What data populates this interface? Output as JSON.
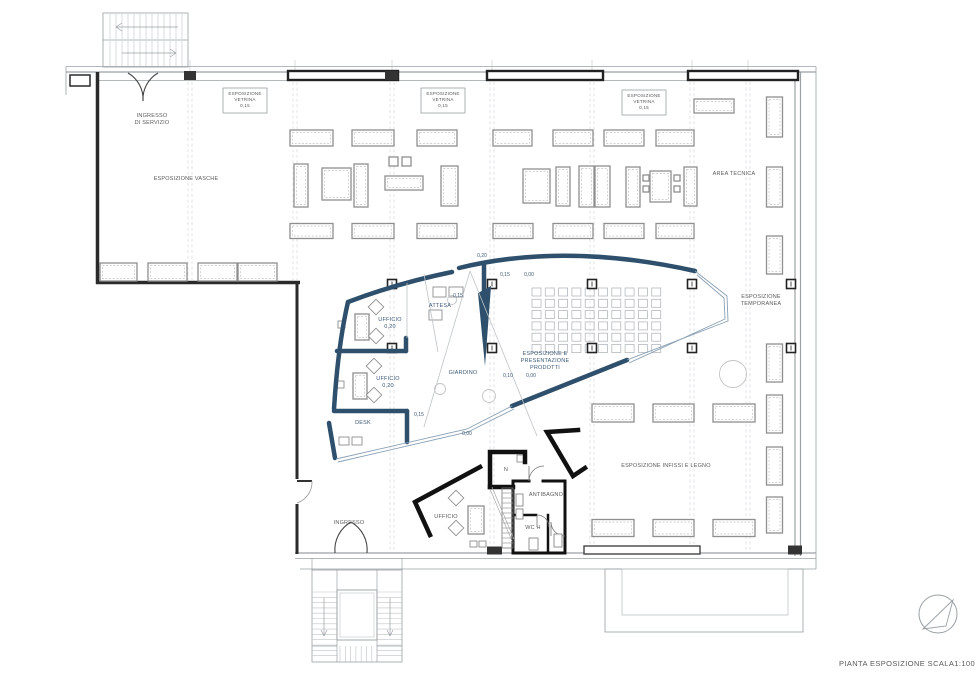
{
  "title": {
    "text": "PIANTA ESPOSIZIONE SCALA1:100",
    "x": 907,
    "y": 666
  },
  "colors": {
    "accent": "#2e506c",
    "accent_thin": "#8aa0b5",
    "wall_dark": "#2a2a2a",
    "room_black": "#111111",
    "furn": "#8f8f8f",
    "furn_inner": "#c4c4c4",
    "thin": "#9aa0a4",
    "lighter": "#bfc3c6",
    "grid": "#cdd1d4",
    "label_gray": "#5a5a5a",
    "label_blue": "#3c5a77"
  },
  "room_labels": [
    {
      "name": "ingresso-di-servizio",
      "lines": [
        "INGRESSO",
        "DI SERVIZIO"
      ],
      "x": 152,
      "y": 117,
      "c": "g"
    },
    {
      "name": "esposizione-vasche",
      "lines": [
        "ESPOSIZIONE VASCHE"
      ],
      "x": 186,
      "y": 180,
      "c": "g"
    },
    {
      "name": "area-tecnica",
      "lines": [
        "AREA TECNICA"
      ],
      "x": 734,
      "y": 175,
      "c": "g"
    },
    {
      "name": "esposizione-temporanea",
      "lines": [
        "ESPOSIZIONE",
        "TEMPORANEA"
      ],
      "x": 761,
      "y": 298,
      "c": "g"
    },
    {
      "name": "esposizione-presentazione-prodotti",
      "lines": [
        "ESPOSIZIONE E",
        "PRESENTAZIONE",
        "PRODOTTI"
      ],
      "x": 545,
      "y": 355,
      "c": "b"
    },
    {
      "name": "esposizione-infissi-legno",
      "lines": [
        "ESPOSIZIONE INFISSI E LEGNO"
      ],
      "x": 666,
      "y": 467,
      "c": "g"
    },
    {
      "name": "ufficio-1",
      "lines": [
        "UFFICIO",
        "0,20"
      ],
      "x": 390,
      "y": 321,
      "c": "b"
    },
    {
      "name": "ufficio-2",
      "lines": [
        "UFFICIO",
        "0,20"
      ],
      "x": 388,
      "y": 380,
      "c": "b"
    },
    {
      "name": "attesa",
      "lines": [
        "ATTESA"
      ],
      "x": 440,
      "y": 307,
      "c": "b"
    },
    {
      "name": "giardino",
      "lines": [
        "GIARDINO"
      ],
      "x": 463,
      "y": 374,
      "c": "b"
    },
    {
      "name": "desk",
      "lines": [
        "DESK"
      ],
      "x": 363,
      "y": 424,
      "c": "b"
    },
    {
      "name": "ingresso",
      "lines": [
        "INGRESSO"
      ],
      "x": 349,
      "y": 524,
      "c": "g"
    },
    {
      "name": "ufficio-basso",
      "lines": [
        "UFFICIO"
      ],
      "x": 446,
      "y": 518,
      "c": "g"
    },
    {
      "name": "n-room",
      "lines": [
        "N"
      ],
      "x": 506,
      "y": 471,
      "c": "g"
    },
    {
      "name": "antibagno",
      "lines": [
        "ANTIBAGNO"
      ],
      "x": 546,
      "y": 496,
      "c": "g"
    },
    {
      "name": "wc-h",
      "lines": [
        "WC H"
      ],
      "x": 533,
      "y": 529,
      "c": "g"
    }
  ],
  "vetrina_boxes": [
    {
      "lines": [
        "ESPOSIZIONE",
        "VETRINA",
        "0,15"
      ],
      "x": 223,
      "y": 88,
      "w": 44,
      "h": 25
    },
    {
      "lines": [
        "ESPOSIZIONE",
        "VETRINA",
        "0,15"
      ],
      "x": 421,
      "y": 88,
      "w": 44,
      "h": 25
    },
    {
      "lines": [
        "ESPOSIZIONE",
        "VETRINA",
        "0,15"
      ],
      "x": 622,
      "y": 90,
      "w": 44,
      "h": 25
    }
  ],
  "elevation_marks": [
    {
      "t": "0,20",
      "x": 482,
      "y": 257
    },
    {
      "t": "0,15",
      "x": 505,
      "y": 276
    },
    {
      "t": "0,00",
      "x": 529,
      "y": 276
    },
    {
      "t": "0,15",
      "x": 458,
      "y": 297
    },
    {
      "t": "0,10",
      "x": 508,
      "y": 377
    },
    {
      "t": "0,00",
      "x": 531,
      "y": 377
    },
    {
      "t": "0,15",
      "x": 419,
      "y": 416
    },
    {
      "t": "0,00",
      "x": 467,
      "y": 435
    }
  ],
  "frame": {
    "thin_lines": [
      [
        66,
        66.5,
        816,
        66.5
      ],
      [
        66,
        72,
        816,
        72
      ],
      [
        98,
        80.5,
        795,
        80.5
      ],
      [
        795,
        72,
        795,
        556
      ],
      [
        800.5,
        72,
        800.5,
        556
      ],
      [
        816,
        66.5,
        816,
        569
      ],
      [
        295,
        553,
        816,
        553
      ],
      [
        295,
        558.5,
        816,
        558.5
      ],
      [
        300,
        569,
        816,
        569
      ],
      [
        66,
        66.5,
        66,
        95
      ]
    ],
    "dark_walls": [
      {
        "x1": 97.5,
        "y1": 72,
        "x2": 97.5,
        "y2": 284,
        "w": 3.5
      },
      {
        "x1": 96,
        "y1": 282.5,
        "x2": 300,
        "y2": 282.5,
        "w": 3.5
      },
      {
        "x1": 297,
        "y1": 284,
        "x2": 297,
        "y2": 479,
        "w": 3
      },
      {
        "x1": 297,
        "y1": 504,
        "x2": 297,
        "y2": 554,
        "w": 3
      }
    ],
    "pier_outline": [
      70,
      75,
      20,
      11
    ],
    "vetrina_bars": [
      [
        288,
        71,
        110,
        9
      ],
      [
        487,
        71,
        116,
        9
      ],
      [
        688,
        71,
        110,
        9
      ]
    ],
    "top_piers": [
      [
        184,
        71,
        12,
        9
      ],
      [
        385,
        71,
        13,
        9
      ]
    ],
    "bottom_piers": [
      [
        487,
        546.5,
        15,
        8
      ],
      [
        587,
        546.5,
        15,
        8
      ],
      [
        788,
        545.5,
        14,
        9
      ]
    ],
    "bottom_window": [
      584,
      546,
      116,
      8
    ],
    "wing_rects": [
      [
        605,
        569,
        198,
        63
      ],
      [
        622,
        569,
        166,
        46
      ]
    ]
  },
  "gridlines": [
    {
      "x": 190,
      "y1": 82,
      "y2": 280
    },
    {
      "x": 295,
      "y1": 82,
      "y2": 280
    },
    {
      "x": 392,
      "y1": 82,
      "y2": 551
    },
    {
      "x": 492,
      "y1": 82,
      "y2": 551
    },
    {
      "x": 592,
      "y1": 82,
      "y2": 551
    },
    {
      "x": 692,
      "y1": 82,
      "y2": 551
    },
    {
      "x": 748,
      "y1": 82,
      "y2": 551
    }
  ],
  "columns": [
    [
      392,
      284
    ],
    [
      492,
      284
    ],
    [
      592,
      284
    ],
    [
      692,
      284
    ],
    [
      392,
      348
    ],
    [
      492,
      348
    ],
    [
      592,
      348
    ],
    [
      692,
      348
    ],
    [
      791,
      284
    ],
    [
      791,
      348
    ]
  ],
  "furniture": {
    "h_rects": [
      [
        290,
        130,
        43,
        16
      ],
      [
        352,
        130,
        42,
        16
      ],
      [
        417,
        130,
        40,
        16
      ],
      [
        493,
        130,
        39,
        16
      ],
      [
        553,
        130,
        40,
        16
      ],
      [
        604,
        130,
        40,
        16
      ],
      [
        656,
        130,
        38,
        16
      ],
      [
        290,
        223.5,
        43,
        15
      ],
      [
        352,
        223.5,
        42,
        15
      ],
      [
        417,
        223.5,
        40,
        15
      ],
      [
        493,
        223.5,
        40,
        15
      ],
      [
        553,
        223.5,
        40,
        15
      ],
      [
        604,
        223.5,
        40,
        15
      ],
      [
        656,
        223.5,
        38,
        15
      ],
      [
        694,
        99,
        40,
        14
      ],
      [
        592,
        404,
        42,
        18
      ],
      [
        653,
        404,
        41,
        18
      ],
      [
        713,
        404,
        42,
        18
      ],
      [
        592,
        519.5,
        42,
        17
      ],
      [
        653,
        519.5,
        41,
        17
      ],
      [
        713,
        519.5,
        42,
        17
      ],
      [
        100,
        263,
        37,
        18
      ],
      [
        148,
        263,
        39,
        18
      ],
      [
        198,
        263,
        39,
        18
      ],
      [
        238,
        263,
        39,
        18
      ]
    ],
    "v_rects": [
      [
        766.5,
        97,
        16,
        40
      ],
      [
        766.5,
        167,
        16,
        40
      ],
      [
        766.5,
        236,
        16,
        38
      ],
      [
        766.5,
        344,
        16,
        38
      ],
      [
        766.5,
        395,
        16,
        38
      ],
      [
        766.5,
        447,
        16,
        38
      ],
      [
        766.5,
        497,
        16,
        36
      ]
    ],
    "mid_items": [
      [
        294,
        164,
        14,
        43
      ],
      [
        322,
        168,
        29,
        32
      ],
      [
        354,
        164,
        14,
        43
      ],
      [
        385,
        176,
        38,
        14
      ],
      [
        389,
        157,
        9,
        9
      ],
      [
        402,
        157,
        9,
        9
      ],
      [
        441,
        166,
        17,
        40
      ],
      [
        523,
        169,
        27,
        34
      ],
      [
        556,
        167,
        14,
        39
      ],
      [
        579,
        166,
        15,
        41
      ],
      [
        595,
        166,
        15,
        41
      ],
      [
        626,
        167,
        14,
        40
      ],
      [
        650,
        171,
        21,
        31
      ],
      [
        643,
        175,
        6,
        6
      ],
      [
        643,
        186,
        6,
        6
      ],
      [
        674,
        175,
        6,
        6
      ],
      [
        674,
        186,
        6,
        6
      ],
      [
        684,
        167,
        13,
        39
      ]
    ],
    "desks": [
      [
        355,
        314,
        14,
        26
      ],
      [
        353,
        373,
        14,
        26
      ],
      [
        468,
        506,
        16,
        28
      ]
    ],
    "small_items": [
      [
        338,
        321,
        7,
        7
      ],
      [
        337,
        381,
        7,
        7
      ],
      [
        339,
        437,
        10,
        8
      ],
      [
        352,
        437,
        10,
        8
      ],
      [
        433,
        287,
        13,
        10
      ],
      [
        449,
        287,
        14,
        10
      ],
      [
        429,
        310,
        13,
        10
      ],
      [
        517,
        455,
        7,
        7
      ],
      [
        470,
        541,
        7,
        6
      ],
      [
        479,
        541,
        7,
        6
      ]
    ],
    "diamonds": [
      [
        376,
        307
      ],
      [
        376,
        336
      ],
      [
        374,
        366
      ],
      [
        374,
        395
      ],
      [
        456,
        498
      ],
      [
        456,
        528
      ]
    ],
    "circles": [
      [
        440,
        389,
        5.5
      ],
      [
        489,
        396,
        6.5
      ],
      [
        452,
        300,
        4.5
      ],
      [
        733,
        374,
        13.5
      ]
    ]
  },
  "product_grid": {
    "x": 532,
    "y": 288,
    "cols": 10,
    "rows": 6,
    "dx": 13.3,
    "dy": 11.3,
    "s": 9,
    "sy": 8
  },
  "blue_shape": {
    "thick": [
      "M348,302 Q398,283 452,272",
      "M459,268 Q565,242 695,271",
      "M348,302 Q338,345 334,409",
      "M337,351 H406",
      "M406,338 V351",
      "M334,411 H407",
      "M407,411 V442",
      "M329,423 L335,458",
      "M512,406 L627,360",
      "M484,263 V298"
    ],
    "fills": [
      "478,293 491,286 485,366"
    ],
    "thin": [
      "M695,271 L727,296 L728,321 L627,360",
      "M697,275 L724,298 L725,319 L629,363",
      "M512,406 L467,429 L336,459",
      "M514,409 L468,432 L338,462"
    ],
    "gray_lines": [
      "M470,271 L424,427",
      "M470,271 L537,436",
      "M407,283 V338",
      "M424,274 L438,352"
    ]
  },
  "black_rooms": {
    "walls": [
      {
        "d": "M480,467 L415,502 L430,535",
        "w": 4.5
      },
      {
        "d": "M490,487 V452 H525 V462",
        "w": 4.5
      },
      {
        "d": "M490,487 H513",
        "w": 4.5
      },
      {
        "d": "M578,430 L547,432 L573,476 L585,468",
        "w": 4.5
      },
      {
        "d": "M513,481 V553",
        "w": 3
      },
      {
        "d": "M513,481 H529",
        "w": 3
      },
      {
        "d": "M543,481 H565",
        "w": 3
      },
      {
        "d": "M565,481 V553",
        "w": 3
      },
      {
        "d": "M515,553 H565",
        "w": 3
      },
      {
        "d": "M513,515 H536",
        "w": 2.5
      },
      {
        "d": "M548,515 V553",
        "w": 2.5
      }
    ],
    "arcs": [
      "M529,481 A15,15 0 0 1 544,466",
      "M529,481 L529,466",
      "M537,515 A12,12 0 0 1 549,527",
      "M537,515 L537,527",
      "M565,536 A14,14 0 0 1 551,522",
      "M551,522 L551,536"
    ],
    "ladder": {
      "x": 502,
      "y": 488,
      "w": 11,
      "h": 60,
      "step": 5
    },
    "diag": [
      "M490,489 L512,541",
      "M492,487 L514,539"
    ],
    "fixtures": [
      [
        516,
        494,
        7,
        12
      ],
      [
        516,
        509,
        7,
        10
      ],
      [
        529,
        538,
        9,
        12
      ],
      [
        554,
        534,
        8,
        13
      ]
    ]
  },
  "doors": {
    "vasche_double": [
      "M128,73 A30,30 0 0 1 143,101",
      "M158,73 A30,30 0 0 0 143,101"
    ],
    "ingresso_double": [
      "M335,553 A32,32 0 0 1 351,522",
      "M367,553 A32,32 0 0 0 351,522"
    ],
    "side_leaf": "M297,481 L312,481",
    "side_arc": "M312,481 A22,22 0 0 1 297,503"
  },
  "stairs": {
    "top_left": {
      "box": [
        103,
        13,
        85,
        54
      ],
      "tread_x1": 110,
      "tread_x2": 182,
      "step": 6,
      "band1": [
        14,
        39
      ],
      "band2": [
        41,
        66
      ],
      "divider_y": 40,
      "arrows": [
        "M178,27 L116,27",
        "M116,27 L122,23",
        "M116,27 L122,31",
        "M122,53 L176,53",
        "M176,53 L170,49",
        "M176,53 L170,57"
      ]
    },
    "bottom": {
      "box": [
        312,
        570,
        90,
        92
      ],
      "lift": [
        337,
        590,
        40,
        50
      ],
      "lift_inset": 3,
      "left_strip": [
        312,
        337,
        592,
        658,
        5.3
      ],
      "right_strip": [
        377,
        402,
        592,
        658,
        5.3
      ],
      "bottom_strip": [
        340,
        377,
        646,
        662,
        5.3
      ],
      "dividers": [
        "M337,570 V662",
        "M377,570 V662",
        "M312,646 H337",
        "M377,646 H402"
      ],
      "connectors": [
        "M312,558 V570",
        "M402,558 V570"
      ],
      "arrows": [
        "M324,598 V636",
        "M324,636 L321,630",
        "M324,636 L327,630",
        "M390,598 V636",
        "M390,636 L387,630",
        "M390,636 L393,630"
      ]
    }
  },
  "north_symbol": {
    "cx": 938,
    "cy": 614,
    "r": 19,
    "path": "M923,629 L953,600 L946,626 Z"
  }
}
